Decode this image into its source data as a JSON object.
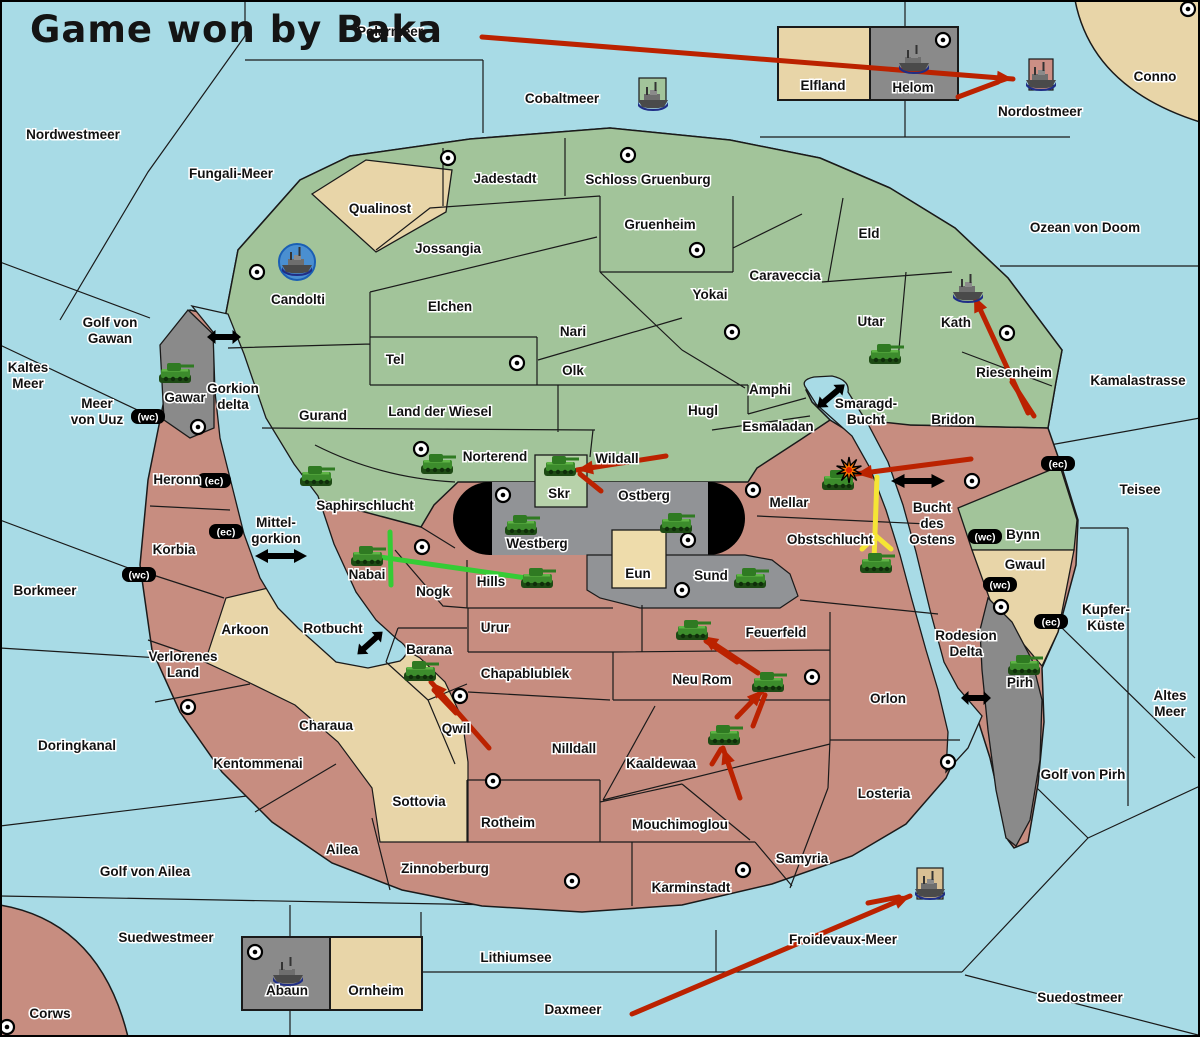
{
  "title": "Game won by Baka",
  "colors": {
    "sea": "#a8dbe6",
    "land_green": "#a2c49a",
    "land_red": "#c78d80",
    "land_tan": "#e8d5a8",
    "land_gray": "#8a8a8a",
    "stadium_gray": "#919396",
    "skr_green": "#b7d2aa",
    "eun_tan": "#eedcab",
    "arrow_red": "#bb2200",
    "arrow_yellow": "#f5e535",
    "mark_green": "#35cc35",
    "port_blue": "#4a8fd0",
    "mount_pink": "#cc8f85",
    "mount_tan": "#d9c094",
    "mount_green": "#a2c49a"
  },
  "labels": [
    {
      "name": "polarmeer",
      "lines": [
        "Polarmeer"
      ],
      "x": 390,
      "y": 36
    },
    {
      "name": "nordwestmeer",
      "lines": [
        "Nordwestmeer"
      ],
      "x": 73,
      "y": 139
    },
    {
      "name": "fungali-meer",
      "lines": [
        "Fungali-Meer"
      ],
      "x": 231,
      "y": 178
    },
    {
      "name": "cobaltmeer",
      "lines": [
        "Cobaltmeer"
      ],
      "x": 562,
      "y": 103
    },
    {
      "name": "nordostmeer",
      "lines": [
        "Nordostmeer"
      ],
      "x": 1040,
      "y": 116
    },
    {
      "name": "conno",
      "lines": [
        "Conno"
      ],
      "x": 1155,
      "y": 81
    },
    {
      "name": "ozean-von-doom",
      "lines": [
        "Ozean von Doom"
      ],
      "x": 1085,
      "y": 232
    },
    {
      "name": "kamalastrasse",
      "lines": [
        "Kamalastrasse"
      ],
      "x": 1138,
      "y": 385
    },
    {
      "name": "teisee",
      "lines": [
        "Teisee"
      ],
      "x": 1140,
      "y": 494
    },
    {
      "name": "kupfer-kueste",
      "lines": [
        "Kupfer-",
        "Küste"
      ],
      "x": 1106,
      "y": 614
    },
    {
      "name": "altes-meer",
      "lines": [
        "Altes",
        "Meer"
      ],
      "x": 1170,
      "y": 700
    },
    {
      "name": "golf-von-pirh",
      "lines": [
        "Golf von Pirh"
      ],
      "x": 1083,
      "y": 779
    },
    {
      "name": "froidevaux-meer",
      "lines": [
        "Froidevaux-Meer"
      ],
      "x": 843,
      "y": 944
    },
    {
      "name": "suedostmeer",
      "lines": [
        "Suedostmeer"
      ],
      "x": 1080,
      "y": 1002
    },
    {
      "name": "daxmeer",
      "lines": [
        "Daxmeer"
      ],
      "x": 573,
      "y": 1014
    },
    {
      "name": "lithiumsee",
      "lines": [
        "Lithiumsee"
      ],
      "x": 516,
      "y": 962
    },
    {
      "name": "suedwestmeer",
      "lines": [
        "Suedwestmeer"
      ],
      "x": 166,
      "y": 942
    },
    {
      "name": "golf-von-ailea",
      "lines": [
        "Golf von Ailea"
      ],
      "x": 145,
      "y": 876
    },
    {
      "name": "doringkanal",
      "lines": [
        "Doringkanal"
      ],
      "x": 77,
      "y": 750
    },
    {
      "name": "borkmeer",
      "lines": [
        "Borkmeer"
      ],
      "x": 45,
      "y": 595
    },
    {
      "name": "kaltes-meer",
      "lines": [
        "Kaltes",
        "Meer"
      ],
      "x": 28,
      "y": 372
    },
    {
      "name": "meer-von-uuz",
      "lines": [
        "Meer",
        "von Uuz"
      ],
      "x": 97,
      "y": 408
    },
    {
      "name": "golf-von-gawan",
      "lines": [
        "Golf von",
        "Gawan"
      ],
      "x": 110,
      "y": 327
    },
    {
      "name": "gorkion-delta",
      "lines": [
        "Gorkion",
        "delta"
      ],
      "x": 233,
      "y": 393
    },
    {
      "name": "mittel-gorkion",
      "lines": [
        "Mittel-",
        "gorkion"
      ],
      "x": 276,
      "y": 527
    },
    {
      "name": "rotbucht",
      "lines": [
        "Rotbucht"
      ],
      "x": 333,
      "y": 633
    },
    {
      "name": "smaragd-bucht",
      "lines": [
        "Smaragd-",
        "Bucht"
      ],
      "x": 866,
      "y": 408
    },
    {
      "name": "bucht-des-ostens",
      "lines": [
        "Bucht",
        "des",
        "Ostens"
      ],
      "x": 932,
      "y": 512
    },
    {
      "name": "rodesion-delta",
      "lines": [
        "Rodesion",
        "Delta"
      ],
      "x": 966,
      "y": 640
    },
    {
      "name": "jadestadt",
      "lines": [
        "Jadestadt"
      ],
      "x": 505,
      "y": 183
    },
    {
      "name": "schloss-gruenburg",
      "lines": [
        "Schloss Gruenburg"
      ],
      "x": 648,
      "y": 184
    },
    {
      "name": "gruenheim",
      "lines": [
        "Gruenheim"
      ],
      "x": 660,
      "y": 229
    },
    {
      "name": "caraveccia",
      "lines": [
        "Caraveccia"
      ],
      "x": 785,
      "y": 280
    },
    {
      "name": "yokai",
      "lines": [
        "Yokai"
      ],
      "x": 710,
      "y": 299
    },
    {
      "name": "jossangia",
      "lines": [
        "Jossangia"
      ],
      "x": 448,
      "y": 253
    },
    {
      "name": "elchen",
      "lines": [
        "Elchen"
      ],
      "x": 450,
      "y": 311
    },
    {
      "name": "nari",
      "lines": [
        "Nari"
      ],
      "x": 573,
      "y": 336
    },
    {
      "name": "tel",
      "lines": [
        "Tel"
      ],
      "x": 395,
      "y": 364
    },
    {
      "name": "olk",
      "lines": [
        "Olk"
      ],
      "x": 573,
      "y": 375
    },
    {
      "name": "land-der-wiesel",
      "lines": [
        "Land der Wiesel"
      ],
      "x": 440,
      "y": 416
    },
    {
      "name": "gurand",
      "lines": [
        "Gurand"
      ],
      "x": 323,
      "y": 420
    },
    {
      "name": "hugl",
      "lines": [
        "Hugl"
      ],
      "x": 703,
      "y": 415
    },
    {
      "name": "amphi",
      "lines": [
        "Amphi"
      ],
      "x": 770,
      "y": 394
    },
    {
      "name": "esmaladan",
      "lines": [
        "Esmaladan"
      ],
      "x": 778,
      "y": 431
    },
    {
      "name": "eld",
      "lines": [
        "Eld"
      ],
      "x": 869,
      "y": 238
    },
    {
      "name": "utar",
      "lines": [
        "Utar"
      ],
      "x": 871,
      "y": 326
    },
    {
      "name": "kath",
      "lines": [
        "Kath"
      ],
      "x": 956,
      "y": 327
    },
    {
      "name": "riesenheim",
      "lines": [
        "Riesenheim"
      ],
      "x": 1014,
      "y": 377
    },
    {
      "name": "candolti",
      "lines": [
        "Candolti"
      ],
      "x": 298,
      "y": 304
    },
    {
      "name": "qualinost",
      "lines": [
        "Qualinost"
      ],
      "x": 380,
      "y": 213
    },
    {
      "name": "norterend",
      "lines": [
        "Norterend"
      ],
      "x": 495,
      "y": 461
    },
    {
      "name": "wildall",
      "lines": [
        "Wildall"
      ],
      "x": 617,
      "y": 463
    },
    {
      "name": "saphirschlucht",
      "lines": [
        "Saphirschlucht"
      ],
      "x": 365,
      "y": 510
    },
    {
      "name": "skr",
      "lines": [
        "Skr"
      ],
      "x": 559,
      "y": 498
    },
    {
      "name": "ostberg",
      "lines": [
        "Ostberg"
      ],
      "x": 644,
      "y": 500
    },
    {
      "name": "westberg",
      "lines": [
        "Westberg"
      ],
      "x": 537,
      "y": 548
    },
    {
      "name": "mellar",
      "lines": [
        "Mellar"
      ],
      "x": 789,
      "y": 507
    },
    {
      "name": "bridon",
      "lines": [
        "Bridon"
      ],
      "x": 953,
      "y": 424
    },
    {
      "name": "bynn",
      "lines": [
        "Bynn"
      ],
      "x": 1023,
      "y": 539
    },
    {
      "name": "eun",
      "lines": [
        "Eun"
      ],
      "x": 638,
      "y": 578
    },
    {
      "name": "sund",
      "lines": [
        "Sund"
      ],
      "x": 711,
      "y": 580
    },
    {
      "name": "obstschlucht",
      "lines": [
        "Obstschlucht"
      ],
      "x": 830,
      "y": 544
    },
    {
      "name": "hills",
      "lines": [
        "Hills"
      ],
      "x": 491,
      "y": 586
    },
    {
      "name": "nabai",
      "lines": [
        "Nabai"
      ],
      "x": 367,
      "y": 579
    },
    {
      "name": "nogk",
      "lines": [
        "Nogk"
      ],
      "x": 433,
      "y": 596
    },
    {
      "name": "gwaul",
      "lines": [
        "Gwaul"
      ],
      "x": 1025,
      "y": 569
    },
    {
      "name": "gawar",
      "lines": [
        "Gawar"
      ],
      "x": 185,
      "y": 402
    },
    {
      "name": "elfland",
      "lines": [
        "Elfland"
      ],
      "x": 823,
      "y": 90
    },
    {
      "name": "helom",
      "lines": [
        "Helom"
      ],
      "x": 913,
      "y": 92
    },
    {
      "name": "heronn",
      "lines": [
        "Heronn"
      ],
      "x": 177,
      "y": 484
    },
    {
      "name": "korbia",
      "lines": [
        "Korbia"
      ],
      "x": 174,
      "y": 554
    },
    {
      "name": "verlorenes-land",
      "lines": [
        "Verlorenes",
        "Land"
      ],
      "x": 183,
      "y": 661
    },
    {
      "name": "arkoon",
      "lines": [
        "Arkoon"
      ],
      "x": 245,
      "y": 634
    },
    {
      "name": "barana",
      "lines": [
        "Barana"
      ],
      "x": 429,
      "y": 654
    },
    {
      "name": "qwil",
      "lines": [
        "Qwil"
      ],
      "x": 456,
      "y": 733
    },
    {
      "name": "urur",
      "lines": [
        "Urur"
      ],
      "x": 495,
      "y": 632
    },
    {
      "name": "chapablublek",
      "lines": [
        "Chapablublek"
      ],
      "x": 525,
      "y": 678
    },
    {
      "name": "neu-rom",
      "lines": [
        "Neu Rom"
      ],
      "x": 702,
      "y": 684
    },
    {
      "name": "feuerfeld",
      "lines": [
        "Feuerfeld"
      ],
      "x": 776,
      "y": 637
    },
    {
      "name": "nilldall",
      "lines": [
        "Nilldall"
      ],
      "x": 574,
      "y": 753
    },
    {
      "name": "kaaldewaa",
      "lines": [
        "Kaaldewaa"
      ],
      "x": 661,
      "y": 768
    },
    {
      "name": "mouchimoglou",
      "lines": [
        "Mouchimoglou"
      ],
      "x": 680,
      "y": 829
    },
    {
      "name": "rotheim",
      "lines": [
        "Rotheim"
      ],
      "x": 508,
      "y": 827
    },
    {
      "name": "sottovia",
      "lines": [
        "Sottovia"
      ],
      "x": 419,
      "y": 806
    },
    {
      "name": "charaua",
      "lines": [
        "Charaua"
      ],
      "x": 326,
      "y": 730
    },
    {
      "name": "kentommenai",
      "lines": [
        "Kentommenai"
      ],
      "x": 258,
      "y": 768
    },
    {
      "name": "ailea",
      "lines": [
        "Ailea"
      ],
      "x": 342,
      "y": 854
    },
    {
      "name": "zinnoberburg",
      "lines": [
        "Zinnoberburg"
      ],
      "x": 445,
      "y": 873
    },
    {
      "name": "karminstadt",
      "lines": [
        "Karminstadt"
      ],
      "x": 691,
      "y": 892
    },
    {
      "name": "samyria",
      "lines": [
        "Samyria"
      ],
      "x": 802,
      "y": 863
    },
    {
      "name": "losteria",
      "lines": [
        "Losteria"
      ],
      "x": 884,
      "y": 798
    },
    {
      "name": "orlon",
      "lines": [
        "Orlon"
      ],
      "x": 888,
      "y": 703
    },
    {
      "name": "pirh",
      "lines": [
        "Pirh"
      ],
      "x": 1020,
      "y": 687
    },
    {
      "name": "abaun",
      "lines": [
        "Abaun"
      ],
      "x": 287,
      "y": 995
    },
    {
      "name": "ornheim",
      "lines": [
        "Ornheim"
      ],
      "x": 376,
      "y": 995
    },
    {
      "name": "corws",
      "lines": [
        "Corws"
      ],
      "x": 50,
      "y": 1018
    }
  ],
  "badges": [
    {
      "text": "(wc)",
      "x": 148,
      "y": 417
    },
    {
      "text": "(ec)",
      "x": 214,
      "y": 481
    },
    {
      "text": "(ec)",
      "x": 226,
      "y": 532
    },
    {
      "text": "(wc)",
      "x": 139,
      "y": 575
    },
    {
      "text": "(ec)",
      "x": 1058,
      "y": 464
    },
    {
      "text": "(wc)",
      "x": 985,
      "y": 537
    },
    {
      "text": "(wc)",
      "x": 1000,
      "y": 585
    },
    {
      "text": "(ec)",
      "x": 1051,
      "y": 622
    }
  ],
  "towns": [
    [
      448,
      158
    ],
    [
      628,
      155
    ],
    [
      697,
      250
    ],
    [
      517,
      363
    ],
    [
      732,
      332
    ],
    [
      257,
      272
    ],
    [
      421,
      449
    ],
    [
      1007,
      333
    ],
    [
      972,
      481
    ],
    [
      198,
      427
    ],
    [
      503,
      495
    ],
    [
      688,
      540
    ],
    [
      682,
      590
    ],
    [
      753,
      490
    ],
    [
      422,
      547
    ],
    [
      460,
      696
    ],
    [
      812,
      677
    ],
    [
      493,
      781
    ],
    [
      572,
      881
    ],
    [
      743,
      870
    ],
    [
      948,
      762
    ],
    [
      188,
      707
    ],
    [
      7,
      1027
    ],
    [
      1188,
      9
    ],
    [
      943,
      40
    ],
    [
      255,
      952
    ],
    [
      1001,
      607
    ]
  ],
  "tanks": [
    [
      175,
      375
    ],
    [
      316,
      478
    ],
    [
      437,
      466
    ],
    [
      560,
      468
    ],
    [
      521,
      527
    ],
    [
      676,
      525
    ],
    [
      750,
      580
    ],
    [
      537,
      580
    ],
    [
      367,
      558
    ],
    [
      838,
      482
    ],
    [
      876,
      565
    ],
    [
      885,
      356
    ],
    [
      420,
      673
    ],
    [
      768,
      684
    ],
    [
      724,
      737
    ],
    [
      692,
      632
    ],
    [
      1024,
      667
    ]
  ],
  "ships": [
    {
      "x": 653,
      "y": 97,
      "mount": "green-square",
      "mx": 639,
      "my": 78,
      "mw": 27,
      "mh": 24
    },
    {
      "x": 297,
      "y": 262,
      "mount": "blue-circle"
    },
    {
      "x": 914,
      "y": 60,
      "mount": "none"
    },
    {
      "x": 1041,
      "y": 77,
      "mount": "pink-square",
      "mx": 1029,
      "my": 59,
      "mw": 24,
      "mh": 31
    },
    {
      "x": 968,
      "y": 289,
      "mount": "none"
    },
    {
      "x": 930,
      "y": 886,
      "mount": "tan-square",
      "mx": 917,
      "my": 868,
      "mw": 26,
      "mh": 31
    },
    {
      "x": 288,
      "y": 972,
      "mount": "none"
    }
  ],
  "red_arrows": [
    {
      "pts": [
        [
          482,
          37
        ],
        [
          1013,
          79
        ]
      ],
      "head": true
    },
    {
      "pts": [
        [
          958,
          97
        ],
        [
          998,
          82
        ]
      ],
      "head": false
    },
    {
      "pts": [
        [
          1028,
          413
        ],
        [
          974,
          296
        ]
      ],
      "head": true
    },
    {
      "pts": [
        [
          1012,
          382
        ],
        [
          1034,
          416
        ]
      ],
      "head": false
    },
    {
      "pts": [
        [
          971,
          459
        ],
        [
          856,
          474
        ]
      ],
      "head": true
    },
    {
      "pts": [
        [
          666,
          456
        ],
        [
          577,
          470
        ]
      ],
      "head": true
    },
    {
      "pts": [
        [
          601,
          491
        ],
        [
          580,
          474
        ]
      ],
      "head": false
    },
    {
      "pts": [
        [
          489,
          748
        ],
        [
          431,
          682
        ]
      ],
      "head": true
    },
    {
      "pts": [
        [
          456,
          713
        ],
        [
          434,
          690
        ]
      ],
      "head": false
    },
    {
      "pts": [
        [
          740,
          798
        ],
        [
          723,
          748
        ]
      ],
      "head": true
    },
    {
      "pts": [
        [
          712,
          764
        ],
        [
          721,
          749
        ]
      ],
      "head": false
    },
    {
      "pts": [
        [
          737,
          717
        ],
        [
          763,
          690
        ]
      ],
      "head": true
    },
    {
      "pts": [
        [
          753,
          726
        ],
        [
          765,
          695
        ]
      ],
      "head": false
    },
    {
      "pts": [
        [
          758,
          673
        ],
        [
          702,
          636
        ]
      ],
      "head": true
    },
    {
      "pts": [
        [
          737,
          662
        ],
        [
          706,
          641
        ]
      ],
      "head": false
    },
    {
      "pts": [
        [
          632,
          1014
        ],
        [
          910,
          896
        ]
      ],
      "head": true
    },
    {
      "pts": [
        [
          868,
          903
        ],
        [
          899,
          897
        ]
      ],
      "head": false
    }
  ],
  "yellow_arrows": [
    {
      "pts": [
        [
          874,
          561
        ],
        [
          877,
          477
        ]
      ]
    },
    {
      "pts": [
        [
          876,
          536
        ],
        [
          862,
          549
        ]
      ]
    },
    {
      "pts": [
        [
          876,
          536
        ],
        [
          891,
          549
        ]
      ]
    }
  ],
  "green_marks": [
    {
      "pts": [
        [
          390,
          532
        ],
        [
          391,
          585
        ]
      ]
    },
    {
      "pts": [
        [
          366,
          555
        ],
        [
          540,
          580
        ]
      ]
    }
  ],
  "crossings": [
    {
      "x": 224,
      "y": 337,
      "angle": 0,
      "len": 34
    },
    {
      "x": 281,
      "y": 556,
      "angle": 0,
      "len": 52
    },
    {
      "x": 831,
      "y": 396,
      "angle": -40,
      "len": 36
    },
    {
      "x": 918,
      "y": 481,
      "angle": 0,
      "len": 54
    },
    {
      "x": 370,
      "y": 643,
      "angle": -42,
      "len": 34
    },
    {
      "x": 976,
      "y": 698,
      "angle": 0,
      "len": 30
    }
  ],
  "explosion": {
    "x": 849,
    "y": 470
  }
}
